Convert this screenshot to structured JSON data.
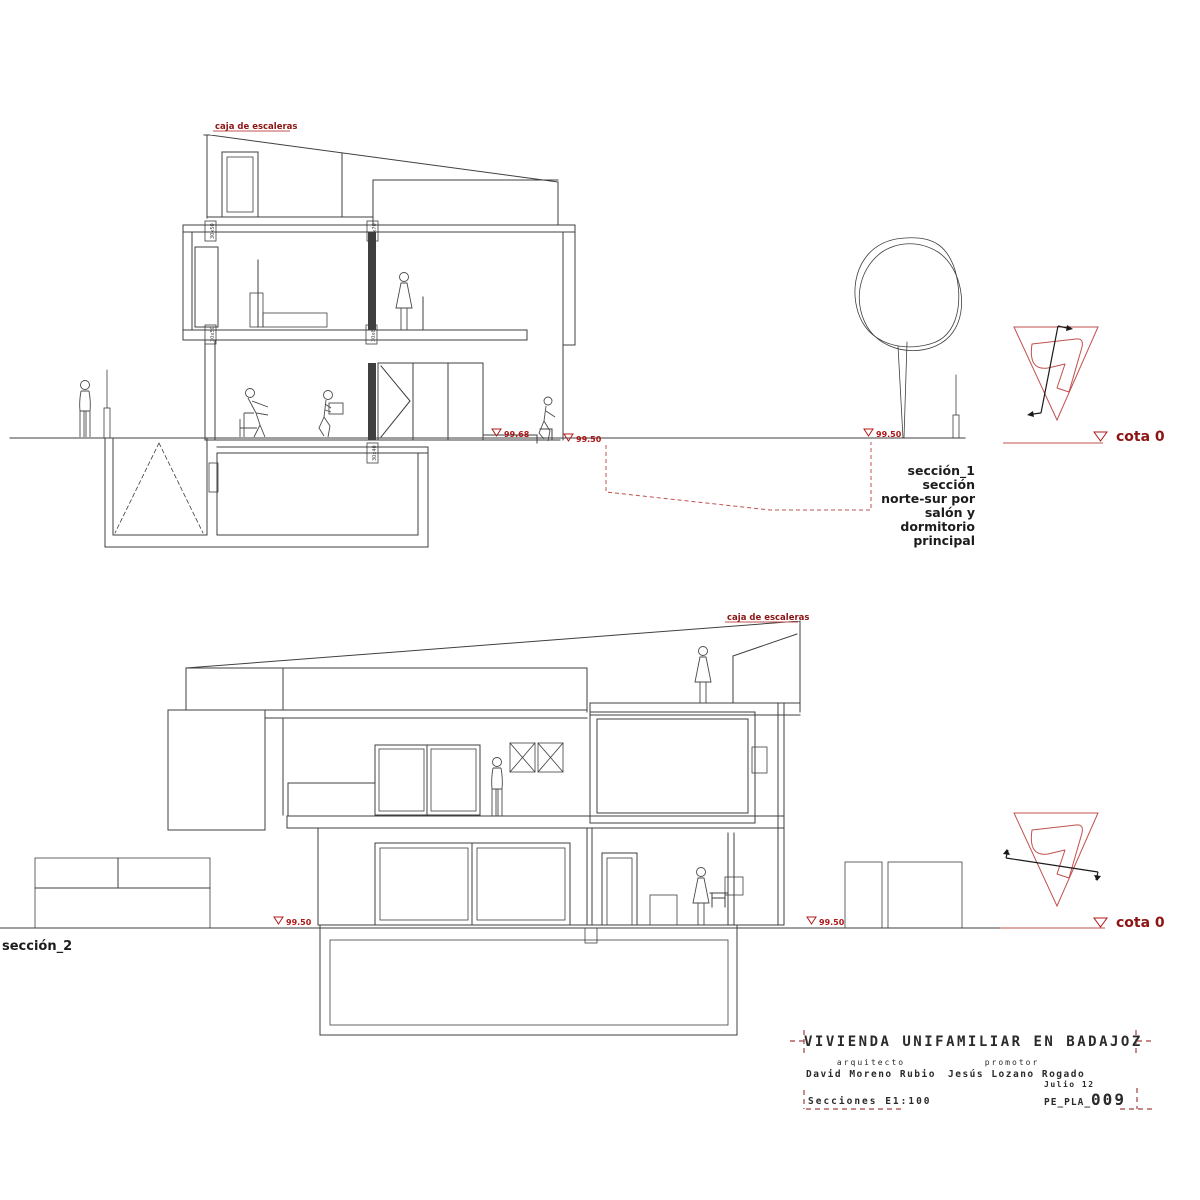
{
  "palette": {
    "line": "#3f3f3f",
    "red_label": "#8e1414",
    "red_line": "#c0504d",
    "marker_red": "#b01818",
    "text_dark": "#1c1c1c"
  },
  "section1": {
    "stair_label": "caja de escaleras",
    "levels": {
      "m1": "99.68",
      "m2": "99.50",
      "m3": "99.50"
    },
    "cota": "cota 0",
    "desc": [
      "sección_1",
      "sección",
      "norte-sur por",
      "salón y",
      "dormitorio",
      "principal"
    ],
    "dims": {
      "roof_left": "30x50",
      "roof_right": "30x70",
      "floor_left": "30x50",
      "floor_right": "30x60",
      "basement": "30x40"
    }
  },
  "section2": {
    "label": "sección_2",
    "stair_label": "caja de escaleras",
    "levels": {
      "m1": "99.50",
      "m2": "99.50"
    },
    "cota": "cota 0"
  },
  "title_block": {
    "title": "VIVIENDA UNIFAMILIAR EN BADAJOZ",
    "architect_role": "arquitecto",
    "architect_name": "David Moreno Rubio",
    "promoter_role": "promotor",
    "promoter_name": "Jesús Lozano Rogado",
    "sheet": "Secciones E1:100",
    "date": "Julio 12",
    "code_prefix": "PE_PLA_",
    "code_number": "009"
  }
}
